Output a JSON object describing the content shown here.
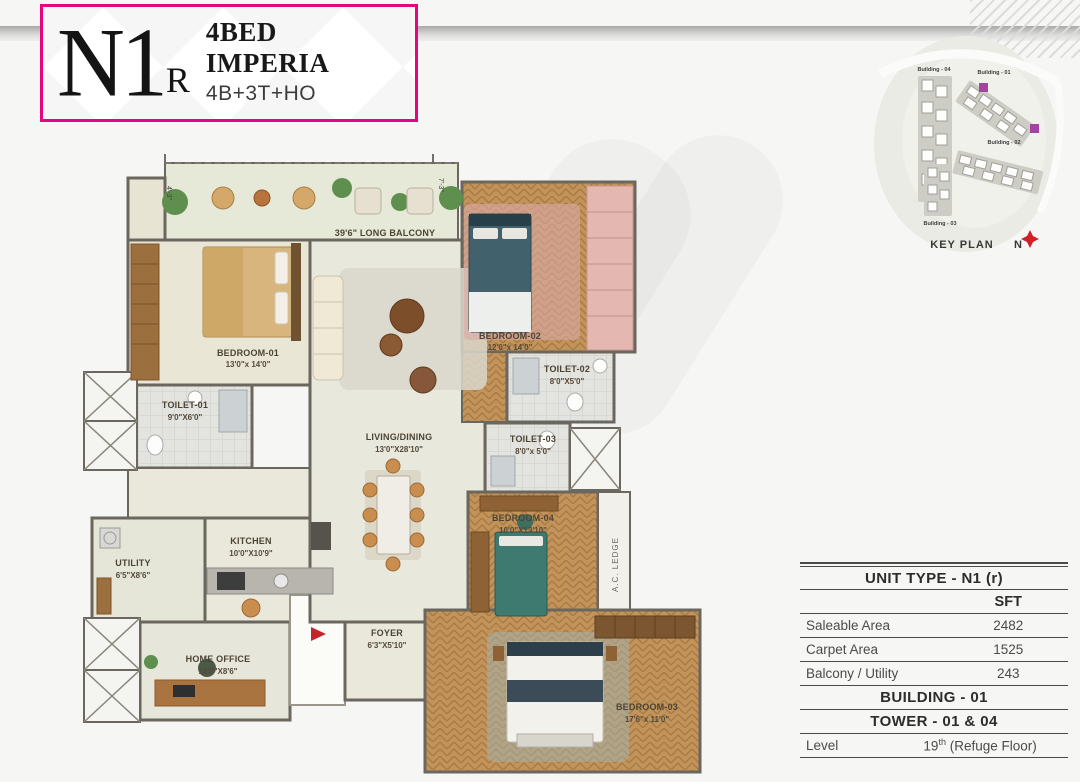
{
  "title_block": {
    "unit_code": "N1",
    "unit_code_suffix": "R",
    "title": "4BED IMPERIA",
    "subtitle": "4B+3T+HO"
  },
  "key_plan": {
    "label": "KEY PLAN",
    "north_label": "N",
    "buildings": [
      {
        "label": "Building - 04"
      },
      {
        "label": "Building - 01"
      },
      {
        "label": "Building - 02"
      },
      {
        "label": "Building - 03"
      }
    ]
  },
  "floor_plan": {
    "balcony_label": "39'6\" LONG BALCONY",
    "ac_ledge_label": "A.C. LEDGE",
    "dims": {
      "left": "4'-3\"",
      "mid": "7'-3\""
    },
    "rooms": {
      "bedroom01": {
        "name": "BEDROOM-01",
        "size": "13'0\"x 14'0\""
      },
      "toilet01": {
        "name": "TOILET-01",
        "size": "9'0\"X6'0\""
      },
      "utility": {
        "name": "UTILITY",
        "size": "6'5\"X8'6\""
      },
      "kitchen": {
        "name": "KITCHEN",
        "size": "10'0\"X10'9\""
      },
      "home_office": {
        "name": "HOME OFFICE",
        "size": "12'0\"X8'6\""
      },
      "living": {
        "name": "LIVING/DINING",
        "size": "13'0\"X28'10\""
      },
      "foyer": {
        "name": "FOYER",
        "size": "6'3\"X5'10\""
      },
      "bedroom02": {
        "name": "BEDROOM-02",
        "size": "12'0\"x 14'0\""
      },
      "toilet02": {
        "name": "TOILET-02",
        "size": "8'0\"X5'0\""
      },
      "toilet03": {
        "name": "TOILET-03",
        "size": "8'0\"x 5'0\""
      },
      "bedroom04": {
        "name": "BEDROOM-04",
        "size": "10'0\"X13'10\""
      },
      "bedroom03": {
        "name": "BEDROOM-03",
        "size": "17'6\"x 11'0\""
      }
    }
  },
  "spec_table": {
    "unit_type_header": "UNIT TYPE - N1 (r)",
    "col_header": "SFT",
    "rows": [
      {
        "label": "Saleable Area",
        "value": "2482"
      },
      {
        "label": "Carpet Area",
        "value": "1525"
      },
      {
        "label": "Balcony / Utility",
        "value": "243"
      }
    ],
    "building": "BUILDING - 01",
    "tower": "TOWER - 01 & 04",
    "level": {
      "label": "Level",
      "num": "19",
      "sup": "th",
      "rest": " (Refuge Floor)"
    }
  },
  "colors": {
    "accent_pink": "#e5057e",
    "keyplan_highlight": "#a443a0",
    "entry_arrow": "#c4242b",
    "wood_floor": "#c2945c",
    "wall": "#6b675e"
  }
}
